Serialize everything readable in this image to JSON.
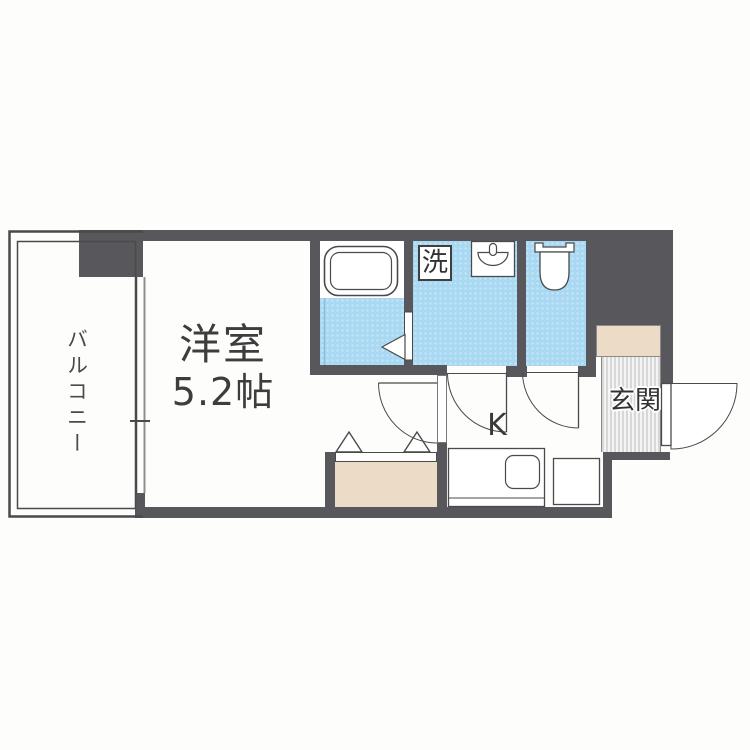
{
  "floor_plan": {
    "labels": {
      "balcony": "バルコニー",
      "room_name": "洋室",
      "room_size": "5.2帖",
      "kitchen": "K",
      "entrance": "玄関",
      "washer": "洗"
    },
    "colors": {
      "wall": "#58575b",
      "wet_area": "#a9d9f2",
      "closet": "#ecdbc6",
      "entrance_hatch": "#d7d7d7",
      "line": "#4a4a4a",
      "text": "#3d3d3d"
    }
  }
}
